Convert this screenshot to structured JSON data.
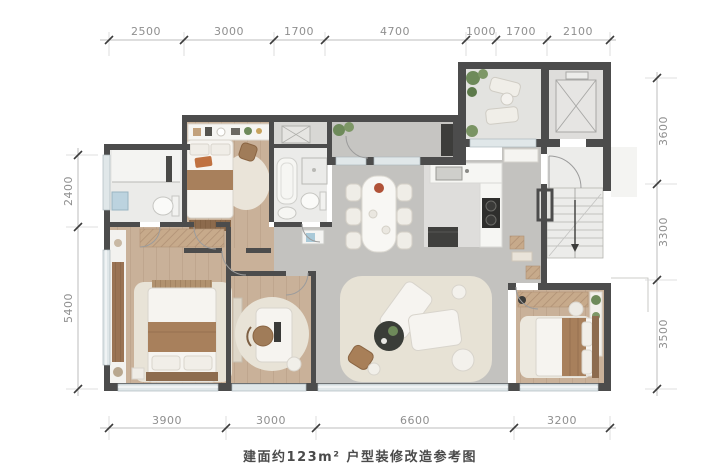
{
  "caption": "建面约123m² 户型装修改造参考图",
  "dimensions": {
    "top": [
      "2500",
      "3000",
      "1700",
      "4700",
      "1000",
      "1700",
      "2100"
    ],
    "bottom": [
      "3900",
      "3000",
      "6600",
      "3200"
    ],
    "left": [
      "2400",
      "5400"
    ],
    "right": [
      "3600",
      "3300",
      "3500"
    ]
  },
  "colors": {
    "wall": "#4c4c4c",
    "wood_floor": "#c9b199",
    "tile_floor": "#c3c2bf",
    "bath_floor": "#ebebe9",
    "terrace_floor": "#e3e3e0",
    "common_floor": "#ececea",
    "rug": "#e8e3d7",
    "plant": "#6e8a5a",
    "bed_blanket": "#a8805c",
    "dim_text": "#8f8f8f"
  }
}
